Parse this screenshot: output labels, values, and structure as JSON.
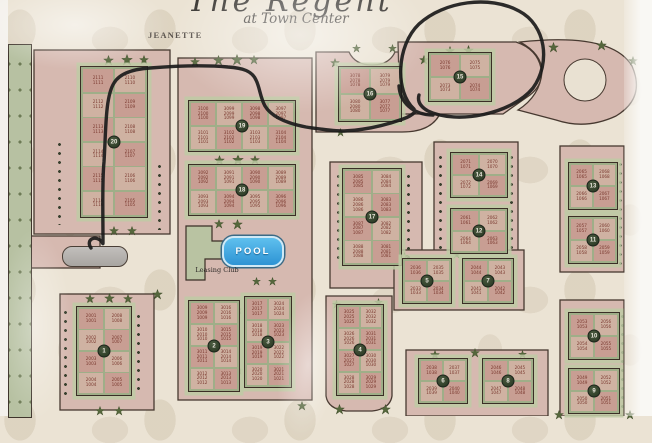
{
  "header": {
    "title_script": "The Regent",
    "subtitle": "at Town Center"
  },
  "labels": {
    "street": "JEANETTE",
    "north": "N",
    "pool": "POOL",
    "leasing": "Leasing Club"
  },
  "annotation": {
    "type": "hand-drawn marker",
    "description": "black marker circle drawn around building 15 with a route line traced from Jeanette street entrance to the circle",
    "circled_building": "15",
    "color": "#1b1b1b"
  },
  "colors": {
    "map_bg": "#ebe3d4",
    "parcel": "#d6b9b0",
    "parcel_outline": "#473930",
    "building_green": "#9fae88",
    "cell_pink": "#c89e93",
    "cell_tan": "#cfb2a2",
    "unit_text": "#7b3a30",
    "number_circle": "#273420",
    "pool_blue": "#2d93d4",
    "tree_green": "#33401f",
    "leasing_green": "#b9c3a2",
    "fountain_gray": "#b3b0ac"
  },
  "map": {
    "buildings": [
      {
        "id": "20",
        "x": 80,
        "y": 66,
        "w": 68,
        "h": 152,
        "cols": 2,
        "units": [
          [
            [
              "2111",
              "1111"
            ],
            [
              "2110",
              "1110"
            ]
          ],
          [
            [
              "2112",
              "1112"
            ],
            [
              "2109",
              "1109"
            ]
          ],
          [
            [
              "2113",
              "1113"
            ],
            [
              "2108",
              "1108"
            ]
          ],
          [
            [
              "2114",
              "1114"
            ],
            [
              "2107",
              "1107"
            ]
          ],
          [
            [
              "2115",
              "1115"
            ],
            [
              "2106",
              "1106"
            ]
          ],
          [
            [
              "2116",
              "1116"
            ],
            [
              "2105",
              "1105"
            ]
          ]
        ]
      },
      {
        "id": "19",
        "x": 188,
        "y": 100,
        "w": 108,
        "h": 52,
        "cols": 4,
        "units": [
          [
            [
              "3100",
              "2100",
              "1100"
            ],
            [
              "3099",
              "2099",
              "1099"
            ],
            [
              "3098",
              "2098",
              "1098"
            ],
            [
              "3097",
              "2097",
              "1097"
            ]
          ],
          [
            [
              "3101",
              "2101",
              "1101"
            ],
            [
              "3102",
              "2102",
              "1102"
            ],
            [
              "3103",
              "2103",
              "1103"
            ],
            [
              "3104",
              "2104",
              "1104"
            ]
          ]
        ]
      },
      {
        "id": "18",
        "x": 188,
        "y": 164,
        "w": 108,
        "h": 52,
        "cols": 4,
        "units": [
          [
            [
              "3092",
              "2092",
              "1092"
            ],
            [
              "3091",
              "2091",
              "1091"
            ],
            [
              "3090",
              "2090",
              "1090"
            ],
            [
              "3089",
              "2089",
              "1089"
            ]
          ],
          [
            [
              "3093",
              "2093",
              "1093"
            ],
            [
              "3094",
              "2094",
              "1094"
            ],
            [
              "3095",
              "2095",
              "1095"
            ],
            [
              "3096",
              "2096",
              "1096"
            ]
          ]
        ]
      },
      {
        "id": "17",
        "x": 342,
        "y": 168,
        "w": 60,
        "h": 98,
        "cols": 2,
        "units": [
          [
            [
              "3085",
              "2085",
              "1085"
            ],
            [
              "3084",
              "2084",
              "1084"
            ]
          ],
          [
            [
              "3086",
              "2086",
              "1086"
            ],
            [
              "3083",
              "2083",
              "1083"
            ]
          ],
          [
            [
              "3087",
              "2087",
              "1087"
            ],
            [
              "3082",
              "2082",
              "1082"
            ]
          ],
          [
            [
              "3088",
              "2088",
              "1088"
            ],
            [
              "3081",
              "2081",
              "1081"
            ]
          ]
        ]
      },
      {
        "id": "16",
        "x": 338,
        "y": 66,
        "w": 64,
        "h": 56,
        "cols": 2,
        "units": [
          [
            [
              "3078",
              "2078",
              "1078"
            ],
            [
              "3079",
              "2079",
              "1079"
            ]
          ],
          [
            [
              "3080",
              "2080",
              "1080"
            ],
            [
              "3077",
              "2077",
              "1077"
            ]
          ]
        ]
      },
      {
        "id": "15",
        "x": 428,
        "y": 52,
        "w": 64,
        "h": 50,
        "cols": 2,
        "units": [
          [
            [
              "2076",
              "1076"
            ],
            [
              "2075",
              "1075"
            ]
          ],
          [
            [
              "2073",
              "1073"
            ],
            [
              "2074",
              "1074"
            ]
          ]
        ]
      },
      {
        "id": "14",
        "x": 450,
        "y": 152,
        "w": 58,
        "h": 46,
        "cols": 2,
        "units": [
          [
            [
              "2071",
              "1071"
            ],
            [
              "2070",
              "1070"
            ]
          ],
          [
            [
              "2072",
              "1072"
            ],
            [
              "2069",
              "1069"
            ]
          ]
        ]
      },
      {
        "id": "13",
        "x": 568,
        "y": 162,
        "w": 50,
        "h": 48,
        "cols": 2,
        "units": [
          [
            [
              "2065",
              "1065"
            ],
            [
              "2068",
              "1068"
            ]
          ],
          [
            [
              "2066",
              "1066"
            ],
            [
              "2067",
              "1067"
            ]
          ]
        ]
      },
      {
        "id": "12",
        "x": 450,
        "y": 208,
        "w": 58,
        "h": 46,
        "cols": 2,
        "units": [
          [
            [
              "2061",
              "1061"
            ],
            [
              "2062",
              "1062"
            ]
          ],
          [
            [
              "2064",
              "1064"
            ],
            [
              "2063",
              "1063"
            ]
          ]
        ]
      },
      {
        "id": "11",
        "x": 568,
        "y": 216,
        "w": 50,
        "h": 48,
        "cols": 2,
        "units": [
          [
            [
              "2057",
              "1057"
            ],
            [
              "2060",
              "1060"
            ]
          ],
          [
            [
              "2058",
              "1058"
            ],
            [
              "2059",
              "1059"
            ]
          ]
        ]
      },
      {
        "id": "10",
        "x": 568,
        "y": 312,
        "w": 52,
        "h": 48,
        "cols": 2,
        "units": [
          [
            [
              "2053",
              "1053"
            ],
            [
              "2056",
              "1056"
            ]
          ],
          [
            [
              "2054",
              "1054"
            ],
            [
              "2055",
              "1055"
            ]
          ]
        ]
      },
      {
        "id": "9",
        "x": 568,
        "y": 368,
        "w": 52,
        "h": 46,
        "cols": 2,
        "units": [
          [
            [
              "2049",
              "1049"
            ],
            [
              "2052",
              "1052"
            ]
          ],
          [
            [
              "2050",
              "1050"
            ],
            [
              "2051",
              "1051"
            ]
          ]
        ]
      },
      {
        "id": "8",
        "x": 482,
        "y": 358,
        "w": 52,
        "h": 46,
        "cols": 2,
        "units": [
          [
            [
              "2046",
              "1046"
            ],
            [
              "2045",
              "1045"
            ]
          ],
          [
            [
              "2047",
              "1047"
            ],
            [
              "2048",
              "1048"
            ]
          ]
        ]
      },
      {
        "id": "7",
        "x": 462,
        "y": 258,
        "w": 52,
        "h": 46,
        "cols": 2,
        "units": [
          [
            [
              "2044",
              "1044"
            ],
            [
              "2043",
              "1043"
            ]
          ],
          [
            [
              "2041",
              "1041"
            ],
            [
              "2042",
              "1042"
            ]
          ]
        ]
      },
      {
        "id": "6",
        "x": 418,
        "y": 358,
        "w": 50,
        "h": 46,
        "cols": 2,
        "units": [
          [
            [
              "2038",
              "1038"
            ],
            [
              "2037",
              "1037"
            ]
          ],
          [
            [
              "2039",
              "1039"
            ],
            [
              "2040",
              "1040"
            ]
          ]
        ]
      },
      {
        "id": "5",
        "x": 402,
        "y": 258,
        "w": 50,
        "h": 46,
        "cols": 2,
        "units": [
          [
            [
              "2036",
              "1036"
            ],
            [
              "2035",
              "1035"
            ]
          ],
          [
            [
              "2033",
              "1033"
            ],
            [
              "2034",
              "1034"
            ]
          ]
        ]
      },
      {
        "id": "4",
        "x": 336,
        "y": 304,
        "w": 48,
        "h": 92,
        "cols": 2,
        "units": [
          [
            [
              "3025",
              "2025",
              "1025"
            ],
            [
              "3032",
              "2032",
              "1032"
            ]
          ],
          [
            [
              "3026",
              "2026",
              "1026"
            ],
            [
              "3031",
              "2031",
              "1031"
            ]
          ],
          [
            [
              "3027",
              "2027",
              "1027"
            ],
            [
              "3030",
              "2030",
              "1030"
            ]
          ],
          [
            [
              "3028",
              "2028",
              "1028"
            ],
            [
              "3029",
              "2029",
              "1029"
            ]
          ]
        ]
      },
      {
        "id": "3",
        "x": 244,
        "y": 296,
        "w": 48,
        "h": 92,
        "cols": 2,
        "units": [
          [
            [
              "3017",
              "2017",
              "1017"
            ],
            [
              "3024",
              "2024",
              "1024"
            ]
          ],
          [
            [
              "3018",
              "2018",
              "1018"
            ],
            [
              "3023",
              "2023",
              "1023"
            ]
          ],
          [
            [
              "3019",
              "2019",
              "1019"
            ],
            [
              "3022",
              "2022",
              "1022"
            ]
          ],
          [
            [
              "3020",
              "2020",
              "1020"
            ],
            [
              "3021",
              "2021",
              "1021"
            ]
          ]
        ]
      },
      {
        "id": "2",
        "x": 188,
        "y": 300,
        "w": 52,
        "h": 92,
        "cols": 2,
        "units": [
          [
            [
              "3009",
              "2009",
              "1009"
            ],
            [
              "3016",
              "2016",
              "1016"
            ]
          ],
          [
            [
              "3010",
              "2010",
              "1010"
            ],
            [
              "3015",
              "2015",
              "1015"
            ]
          ],
          [
            [
              "3011",
              "2011",
              "1011"
            ],
            [
              "3014",
              "2014",
              "1014"
            ]
          ],
          [
            [
              "3012",
              "2012",
              "1012"
            ],
            [
              "3013",
              "2013",
              "1013"
            ]
          ]
        ]
      },
      {
        "id": "1",
        "x": 76,
        "y": 306,
        "w": 56,
        "h": 90,
        "cols": 2,
        "units": [
          [
            [
              "2001",
              "1001"
            ],
            [
              "2008",
              "1008"
            ]
          ],
          [
            [
              "2002",
              "1002"
            ],
            [
              "2007",
              "1007"
            ]
          ],
          [
            [
              "2003",
              "1003"
            ],
            [
              "2006",
              "1006"
            ]
          ],
          [
            [
              "2004",
              "1004"
            ],
            [
              "2005",
              "1005"
            ]
          ]
        ]
      }
    ],
    "trees": [
      {
        "x": 103,
        "y": 55,
        "s": 11
      },
      {
        "x": 121,
        "y": 54,
        "s": 12
      },
      {
        "x": 139,
        "y": 55,
        "s": 10
      },
      {
        "x": 109,
        "y": 226,
        "s": 10
      },
      {
        "x": 127,
        "y": 226,
        "s": 10
      },
      {
        "x": 190,
        "y": 57,
        "s": 10
      },
      {
        "x": 213,
        "y": 55,
        "s": 11
      },
      {
        "x": 231,
        "y": 54,
        "s": 12
      },
      {
        "x": 249,
        "y": 55,
        "s": 10
      },
      {
        "x": 214,
        "y": 155,
        "s": 11
      },
      {
        "x": 232,
        "y": 154,
        "s": 12
      },
      {
        "x": 250,
        "y": 155,
        "s": 10
      },
      {
        "x": 214,
        "y": 219,
        "s": 10
      },
      {
        "x": 232,
        "y": 219,
        "s": 11
      },
      {
        "x": 152,
        "y": 289,
        "s": 11
      },
      {
        "x": 252,
        "y": 277,
        "s": 9
      },
      {
        "x": 268,
        "y": 277,
        "s": 9
      },
      {
        "x": 233,
        "y": 305,
        "s": 10
      },
      {
        "x": 233,
        "y": 365,
        "s": 11
      },
      {
        "x": 85,
        "y": 294,
        "s": 10
      },
      {
        "x": 104,
        "y": 293,
        "s": 11
      },
      {
        "x": 123,
        "y": 294,
        "s": 10
      },
      {
        "x": 95,
        "y": 406,
        "s": 10
      },
      {
        "x": 114,
        "y": 406,
        "s": 10
      },
      {
        "x": 330,
        "y": 58,
        "s": 10
      },
      {
        "x": 352,
        "y": 44,
        "s": 9
      },
      {
        "x": 388,
        "y": 44,
        "s": 9
      },
      {
        "x": 419,
        "y": 55,
        "s": 10
      },
      {
        "x": 445,
        "y": 46,
        "s": 10
      },
      {
        "x": 463,
        "y": 45,
        "s": 11
      },
      {
        "x": 548,
        "y": 42,
        "s": 11
      },
      {
        "x": 596,
        "y": 40,
        "s": 11
      },
      {
        "x": 628,
        "y": 56,
        "s": 10
      },
      {
        "x": 336,
        "y": 128,
        "s": 9
      },
      {
        "x": 406,
        "y": 288,
        "s": 10
      },
      {
        "x": 332,
        "y": 300,
        "s": 9
      },
      {
        "x": 374,
        "y": 298,
        "s": 9
      },
      {
        "x": 334,
        "y": 404,
        "s": 11
      },
      {
        "x": 380,
        "y": 404,
        "s": 11
      },
      {
        "x": 297,
        "y": 401,
        "s": 10
      },
      {
        "x": 400,
        "y": 252,
        "s": 9
      },
      {
        "x": 452,
        "y": 250,
        "s": 9
      },
      {
        "x": 430,
        "y": 350,
        "s": 10
      },
      {
        "x": 470,
        "y": 348,
        "s": 10
      },
      {
        "x": 518,
        "y": 350,
        "s": 9
      },
      {
        "x": 554,
        "y": 410,
        "s": 10
      },
      {
        "x": 625,
        "y": 410,
        "s": 10
      }
    ],
    "dot_strips": [
      {
        "x": 57,
        "y": 140,
        "h": 85
      },
      {
        "x": 157,
        "y": 162,
        "h": 68
      },
      {
        "x": 63,
        "y": 308,
        "h": 92
      },
      {
        "x": 136,
        "y": 312,
        "h": 84
      },
      {
        "x": 438,
        "y": 153,
        "h": 102
      },
      {
        "x": 509,
        "y": 153,
        "h": 102
      },
      {
        "x": 618,
        "y": 160,
        "h": 108
      },
      {
        "x": 620,
        "y": 312,
        "h": 98
      },
      {
        "x": 336,
        "y": 172,
        "h": 90
      },
      {
        "x": 406,
        "y": 172,
        "h": 90
      }
    ]
  }
}
